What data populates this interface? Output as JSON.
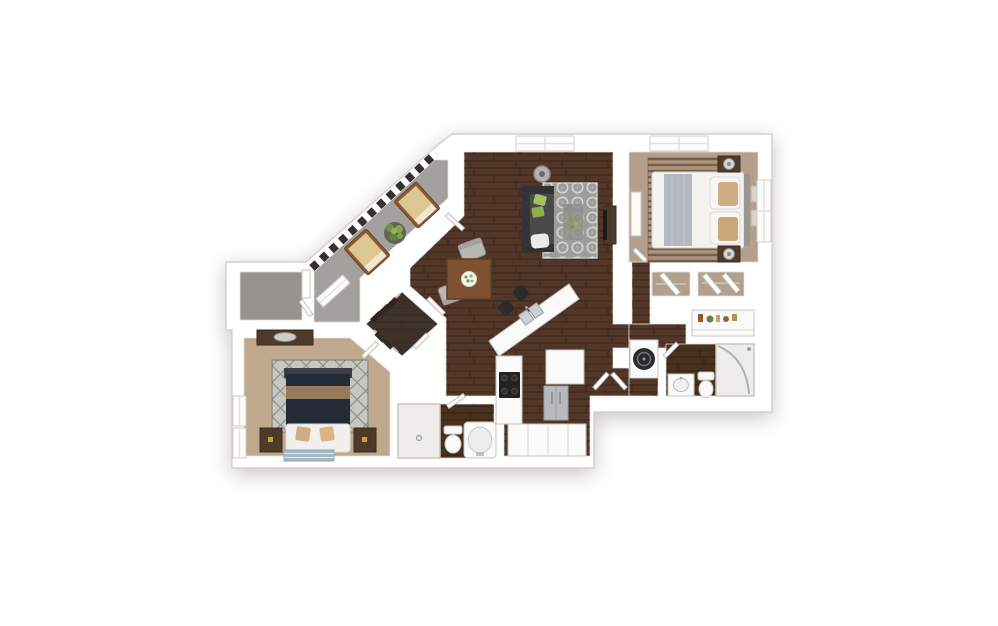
{
  "palette": {
    "page_bg": "#ffffff",
    "wall": "#ffffff",
    "hardwood": "#523728",
    "hardwood_dark": "#49311f",
    "carpet_master": "#b2a08c",
    "carpet_bedroom2": "#c0a88d",
    "carpet_closet": "#b2a08c",
    "concrete_balcony": "#a3a19d",
    "concrete_storage": "#96948f",
    "closet_floor": "#3f322a",
    "living_rug": "#9d9d99",
    "living_rug_center": "#8f8f8b",
    "master_rug": "#ab937c",
    "bedroom2_rug": "#c7c7c1",
    "accent_rug_blue": "#a5b8c6",
    "sofa": "#3c3c3e",
    "bed_white": "#f3f2ef",
    "bed_runner": "#b3b8bf",
    "bed_navy": "#232b39",
    "pillow_tan": "#cfae81",
    "throw_brown": "#997a58",
    "wood_dark": "#4e3a28",
    "wood_table": "#7e5230",
    "stainless": "#b8bbbd",
    "appliance_black": "#232323",
    "fixture_white": "#fafaf8",
    "shower_tile": "#efedea",
    "plant_green": "#7fa348",
    "pillow_green": "#a4c162",
    "railing": "#35302b",
    "chaise_cushion": "#ddc691",
    "chaise_frame": "#8a5a33",
    "vases": [
      "#8a5a33",
      "#6b7d4f",
      "#c9a06a",
      "#87683f",
      "#b98c5a"
    ]
  },
  "plan": {
    "type": "3d-floor-plan-render",
    "rooms": [
      {
        "name": "balcony",
        "floor": "concrete"
      },
      {
        "name": "storage-room",
        "floor": "concrete"
      },
      {
        "name": "living-room",
        "floor": "hardwood"
      },
      {
        "name": "dining-area",
        "floor": "hardwood"
      },
      {
        "name": "kitchen",
        "floor": "hardwood"
      },
      {
        "name": "master-bedroom",
        "floor": "carpet"
      },
      {
        "name": "master-closets",
        "floor": "carpet"
      },
      {
        "name": "linen-niche",
        "floor": "wall"
      },
      {
        "name": "laundry-closet",
        "floor": "wall"
      },
      {
        "name": "hall-bathroom",
        "floor": "hardwood"
      },
      {
        "name": "bedroom-2",
        "floor": "carpet"
      },
      {
        "name": "walk-in-closet",
        "floor": "hardwood"
      },
      {
        "name": "bathroom-2",
        "floor": "hardwood"
      }
    ],
    "furniture": [
      "sofa",
      "living-area-rug",
      "tv-console",
      "ceiling-light",
      "dining-table",
      "dining-chairs",
      "breakfast-bar",
      "bar-stools",
      "kitchen-sink",
      "stove",
      "refrigerator",
      "pantry-shelves",
      "master-bed",
      "nightstands",
      "lamps",
      "dresser",
      "wall-art",
      "bedroom2-bed",
      "bedroom2-dresser-mirror",
      "accent-rugs",
      "chaise-lounges",
      "potted-plant",
      "washer-dryer",
      "toilets",
      "bathtub",
      "showers",
      "vanity-sinks",
      "closet-rods",
      "hanging-clothes",
      "decor-vases"
    ]
  }
}
